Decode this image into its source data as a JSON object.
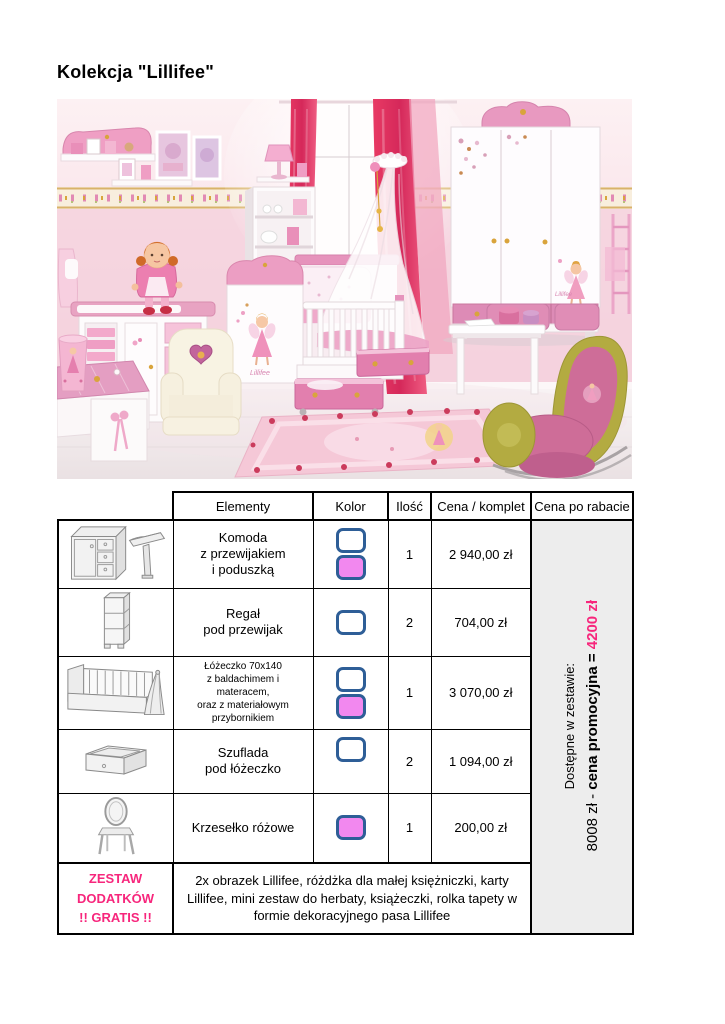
{
  "page": {
    "title": "Kolekcja \"Lillifee\""
  },
  "colors": {
    "accent_pink": "#f7267c",
    "swatch_border": "#2e5e97",
    "swatch_white": "#ffffff",
    "swatch_pink": "#f288ef",
    "rebate_cell_bg": "#ededed"
  },
  "photo": {
    "decal_text": "Lillifee"
  },
  "table": {
    "headers": {
      "elements": "Elementy",
      "color": "Kolor",
      "qty": "Ilość",
      "price": "Cena / komplet",
      "rebate": "Cena po rabacie"
    },
    "rows": [
      {
        "icon": "komoda-icon",
        "element": "Komoda\nz przewijakiem\ni poduszką",
        "swatches": [
          "white",
          "pink"
        ],
        "qty": "1",
        "price": "2 940,00 zł"
      },
      {
        "icon": "regal-icon",
        "element": "Regał\npod przewijak",
        "swatches": [
          "white"
        ],
        "qty": "2",
        "price": "704,00 zł"
      },
      {
        "icon": "lozeczko-icon",
        "element": "Łóżeczko 70x140\nz baldachimem i\nmateracem,\noraz z materiałowym\nprzybornikiem",
        "swatches": [
          "white",
          "pink"
        ],
        "qty": "1",
        "price": "3 070,00 zł"
      },
      {
        "icon": "szuflada-icon",
        "element": "Szuflada\npod łóżeczko",
        "swatches": [
          "white"
        ],
        "qty": "2",
        "price": "1 094,00 zł"
      },
      {
        "icon": "krzeselko-icon",
        "element": "Krzesełko różowe",
        "swatches": [
          "pink"
        ],
        "qty": "1",
        "price": "200,00 zł"
      }
    ],
    "gratis_row": {
      "label": "ZESTAW\nDODATKÓW\n!! GRATIS !!",
      "description": "2x obrazek Lillifee, różdżka dla małej księżniczki, karty Lillifee, mini zestaw do herbaty, książeczki, rolka tapety w formie dekoracyjnego pasa Lillifee"
    },
    "rebate_note": {
      "line1": "Dostępne w zestawie:",
      "line2_prefix": "8008 zł - ",
      "line2_bold": "cena promocyjna = ",
      "line2_highlight": "4200 zł"
    }
  }
}
